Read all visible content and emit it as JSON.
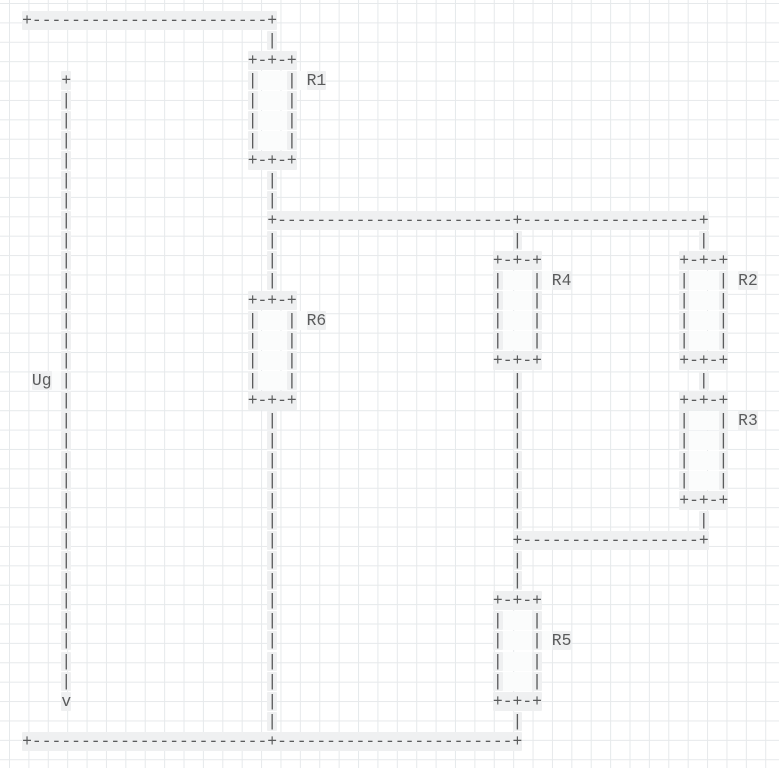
{
  "meta": {
    "description": "ASCII-art electrical circuit diagram on a light grid background",
    "diagram_type": "circuit"
  },
  "colors": {
    "page_bg": "#ffffff",
    "grid_line": "#e6e9eb",
    "cell_bg": "#eff0f1",
    "inner_bg": "#fbfcfc",
    "glyph": "#5a5b5c"
  },
  "components": {
    "source_label": "Ug",
    "source_polarity_top": "+",
    "source_arrow_bottom": "v",
    "resistor_labels": [
      "R1",
      "R2",
      "R3",
      "R4",
      "R5",
      "R6"
    ]
  },
  "diagram": {
    "rows": [
      {
        "segments": [
          [
            0,
            "+------------------------+"
          ]
        ]
      },
      {
        "segments": [
          [
            25,
            "|"
          ]
        ]
      },
      {
        "segments": [
          [
            23,
            "+-+-+"
          ]
        ]
      },
      {
        "segments": [
          [
            4,
            "+"
          ],
          [
            23,
            "|   |"
          ],
          [
            29,
            "R1"
          ]
        ]
      },
      {
        "segments": [
          [
            4,
            "|"
          ],
          [
            23,
            "|   |"
          ]
        ]
      },
      {
        "segments": [
          [
            4,
            "|"
          ],
          [
            23,
            "|   |"
          ]
        ]
      },
      {
        "segments": [
          [
            4,
            "|"
          ],
          [
            23,
            "|   |"
          ]
        ]
      },
      {
        "segments": [
          [
            4,
            "|"
          ],
          [
            23,
            "+-+-+"
          ]
        ]
      },
      {
        "segments": [
          [
            4,
            "|"
          ],
          [
            25,
            "|"
          ]
        ]
      },
      {
        "segments": [
          [
            4,
            "|"
          ],
          [
            25,
            "|"
          ]
        ]
      },
      {
        "segments": [
          [
            4,
            "|"
          ],
          [
            25,
            "+------------------------+------------------+"
          ]
        ]
      },
      {
        "segments": [
          [
            4,
            "|"
          ],
          [
            25,
            "|"
          ],
          [
            50,
            "|"
          ],
          [
            69,
            "|"
          ]
        ]
      },
      {
        "segments": [
          [
            4,
            "|"
          ],
          [
            25,
            "|"
          ],
          [
            48,
            "+-+-+"
          ],
          [
            67,
            "+-+-+"
          ]
        ]
      },
      {
        "segments": [
          [
            4,
            "|"
          ],
          [
            25,
            "|"
          ],
          [
            48,
            "|   |"
          ],
          [
            54,
            "R4"
          ],
          [
            67,
            "|   |"
          ],
          [
            73,
            "R2"
          ]
        ]
      },
      {
        "segments": [
          [
            4,
            "|"
          ],
          [
            23,
            "+-+-+"
          ],
          [
            48,
            "|   |"
          ],
          [
            67,
            "|   |"
          ]
        ]
      },
      {
        "segments": [
          [
            4,
            "|"
          ],
          [
            23,
            "|   |"
          ],
          [
            29,
            "R6"
          ],
          [
            48,
            "|   |"
          ],
          [
            67,
            "|   |"
          ]
        ]
      },
      {
        "segments": [
          [
            4,
            "|"
          ],
          [
            23,
            "|   |"
          ],
          [
            48,
            "|   |"
          ],
          [
            67,
            "|   |"
          ]
        ]
      },
      {
        "segments": [
          [
            4,
            "|"
          ],
          [
            23,
            "|   |"
          ],
          [
            48,
            "+-+-+"
          ],
          [
            67,
            "+-+-+"
          ]
        ]
      },
      {
        "segments": [
          [
            1,
            "Ug"
          ],
          [
            4,
            "|"
          ],
          [
            23,
            "|   |"
          ],
          [
            50,
            "|"
          ],
          [
            69,
            "|"
          ]
        ]
      },
      {
        "segments": [
          [
            4,
            "|"
          ],
          [
            23,
            "+-+-+"
          ],
          [
            50,
            "|"
          ],
          [
            67,
            "+-+-+"
          ]
        ]
      },
      {
        "segments": [
          [
            4,
            "|"
          ],
          [
            25,
            "|"
          ],
          [
            50,
            "|"
          ],
          [
            67,
            "|   |"
          ],
          [
            73,
            "R3"
          ]
        ]
      },
      {
        "segments": [
          [
            4,
            "|"
          ],
          [
            25,
            "|"
          ],
          [
            50,
            "|"
          ],
          [
            67,
            "|   |"
          ]
        ]
      },
      {
        "segments": [
          [
            4,
            "|"
          ],
          [
            25,
            "|"
          ],
          [
            50,
            "|"
          ],
          [
            67,
            "|   |"
          ]
        ]
      },
      {
        "segments": [
          [
            4,
            "|"
          ],
          [
            25,
            "|"
          ],
          [
            50,
            "|"
          ],
          [
            67,
            "|   |"
          ]
        ]
      },
      {
        "segments": [
          [
            4,
            "|"
          ],
          [
            25,
            "|"
          ],
          [
            50,
            "|"
          ],
          [
            67,
            "+-+-+"
          ]
        ]
      },
      {
        "segments": [
          [
            4,
            "|"
          ],
          [
            25,
            "|"
          ],
          [
            50,
            "|"
          ],
          [
            69,
            "|"
          ]
        ]
      },
      {
        "segments": [
          [
            4,
            "|"
          ],
          [
            25,
            "|"
          ],
          [
            50,
            "+------------------+"
          ]
        ]
      },
      {
        "segments": [
          [
            4,
            "|"
          ],
          [
            25,
            "|"
          ],
          [
            50,
            "|"
          ]
        ]
      },
      {
        "segments": [
          [
            4,
            "|"
          ],
          [
            25,
            "|"
          ],
          [
            50,
            "|"
          ]
        ]
      },
      {
        "segments": [
          [
            4,
            "|"
          ],
          [
            25,
            "|"
          ],
          [
            48,
            "+-+-+"
          ]
        ]
      },
      {
        "segments": [
          [
            4,
            "|"
          ],
          [
            25,
            "|"
          ],
          [
            48,
            "|   |"
          ]
        ]
      },
      {
        "segments": [
          [
            4,
            "|"
          ],
          [
            25,
            "|"
          ],
          [
            48,
            "|   |"
          ],
          [
            54,
            "R5"
          ]
        ]
      },
      {
        "segments": [
          [
            4,
            "|"
          ],
          [
            25,
            "|"
          ],
          [
            48,
            "|   |"
          ]
        ]
      },
      {
        "segments": [
          [
            4,
            "|"
          ],
          [
            25,
            "|"
          ],
          [
            48,
            "|   |"
          ]
        ]
      },
      {
        "segments": [
          [
            4,
            "v"
          ],
          [
            25,
            "|"
          ],
          [
            48,
            "+-+-+"
          ]
        ]
      },
      {
        "segments": [
          [
            25,
            "|"
          ],
          [
            50,
            "|"
          ]
        ]
      },
      {
        "segments": [
          [
            0,
            "+------------------------+------------------------+"
          ]
        ]
      }
    ]
  }
}
